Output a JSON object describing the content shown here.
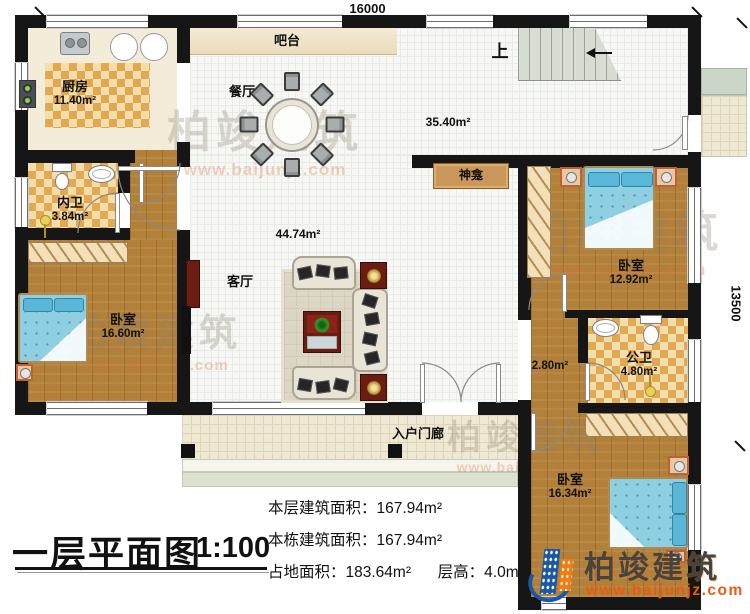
{
  "title_block": {
    "title": "一层平面图",
    "scale": "1:100"
  },
  "stats": {
    "floor_area_label": "本层建筑面积：",
    "floor_area_value": "167.94m²",
    "building_area_label": "本栋建筑面积：",
    "building_area_value": "167.94m²",
    "land_area_label": "占地面积：",
    "land_area_value": "183.64m²",
    "height_label": "层高：",
    "height_value": "4.0m"
  },
  "dimensions": {
    "width": "16000",
    "height": "13500"
  },
  "rooms": {
    "kitchen": {
      "name": "厨房",
      "area": "11.40m²"
    },
    "bar": {
      "name": "吧台"
    },
    "dining": {
      "name": "餐厅"
    },
    "foyer": {
      "area": "35.40m²"
    },
    "stairs": {
      "label": "上"
    },
    "inner_bath": {
      "name": "内卫",
      "area": "3.84m²"
    },
    "bedroom_left": {
      "name": "卧室",
      "area": "16.60m²"
    },
    "living": {
      "name": "客厅",
      "area": "44.74m²"
    },
    "shrine": {
      "name": "神龛"
    },
    "bedroom_right": {
      "name": "卧室",
      "area": "12.92m²"
    },
    "public_bath": {
      "name": "公卫",
      "area": "4.80m²"
    },
    "hallway": {
      "area": "2.80m²"
    },
    "bedroom_bottom": {
      "name": "卧室",
      "area": "16.34m²"
    },
    "porch": {
      "name": "入户门廊"
    }
  },
  "watermark": {
    "brand": "柏竣建筑",
    "url": "www.baijunjz.com"
  },
  "logo": {
    "brand": "柏竣建筑",
    "url": "www.baijunjz.com"
  },
  "colors": {
    "wall": "#161616",
    "wood": "#b28039",
    "checker_light": "#f2ddad",
    "checker_dark": "#e2a952",
    "bed_blue": "#8ecfe2",
    "logo_blue": "#1a57a5",
    "logo_orange": "#ef7d12"
  }
}
